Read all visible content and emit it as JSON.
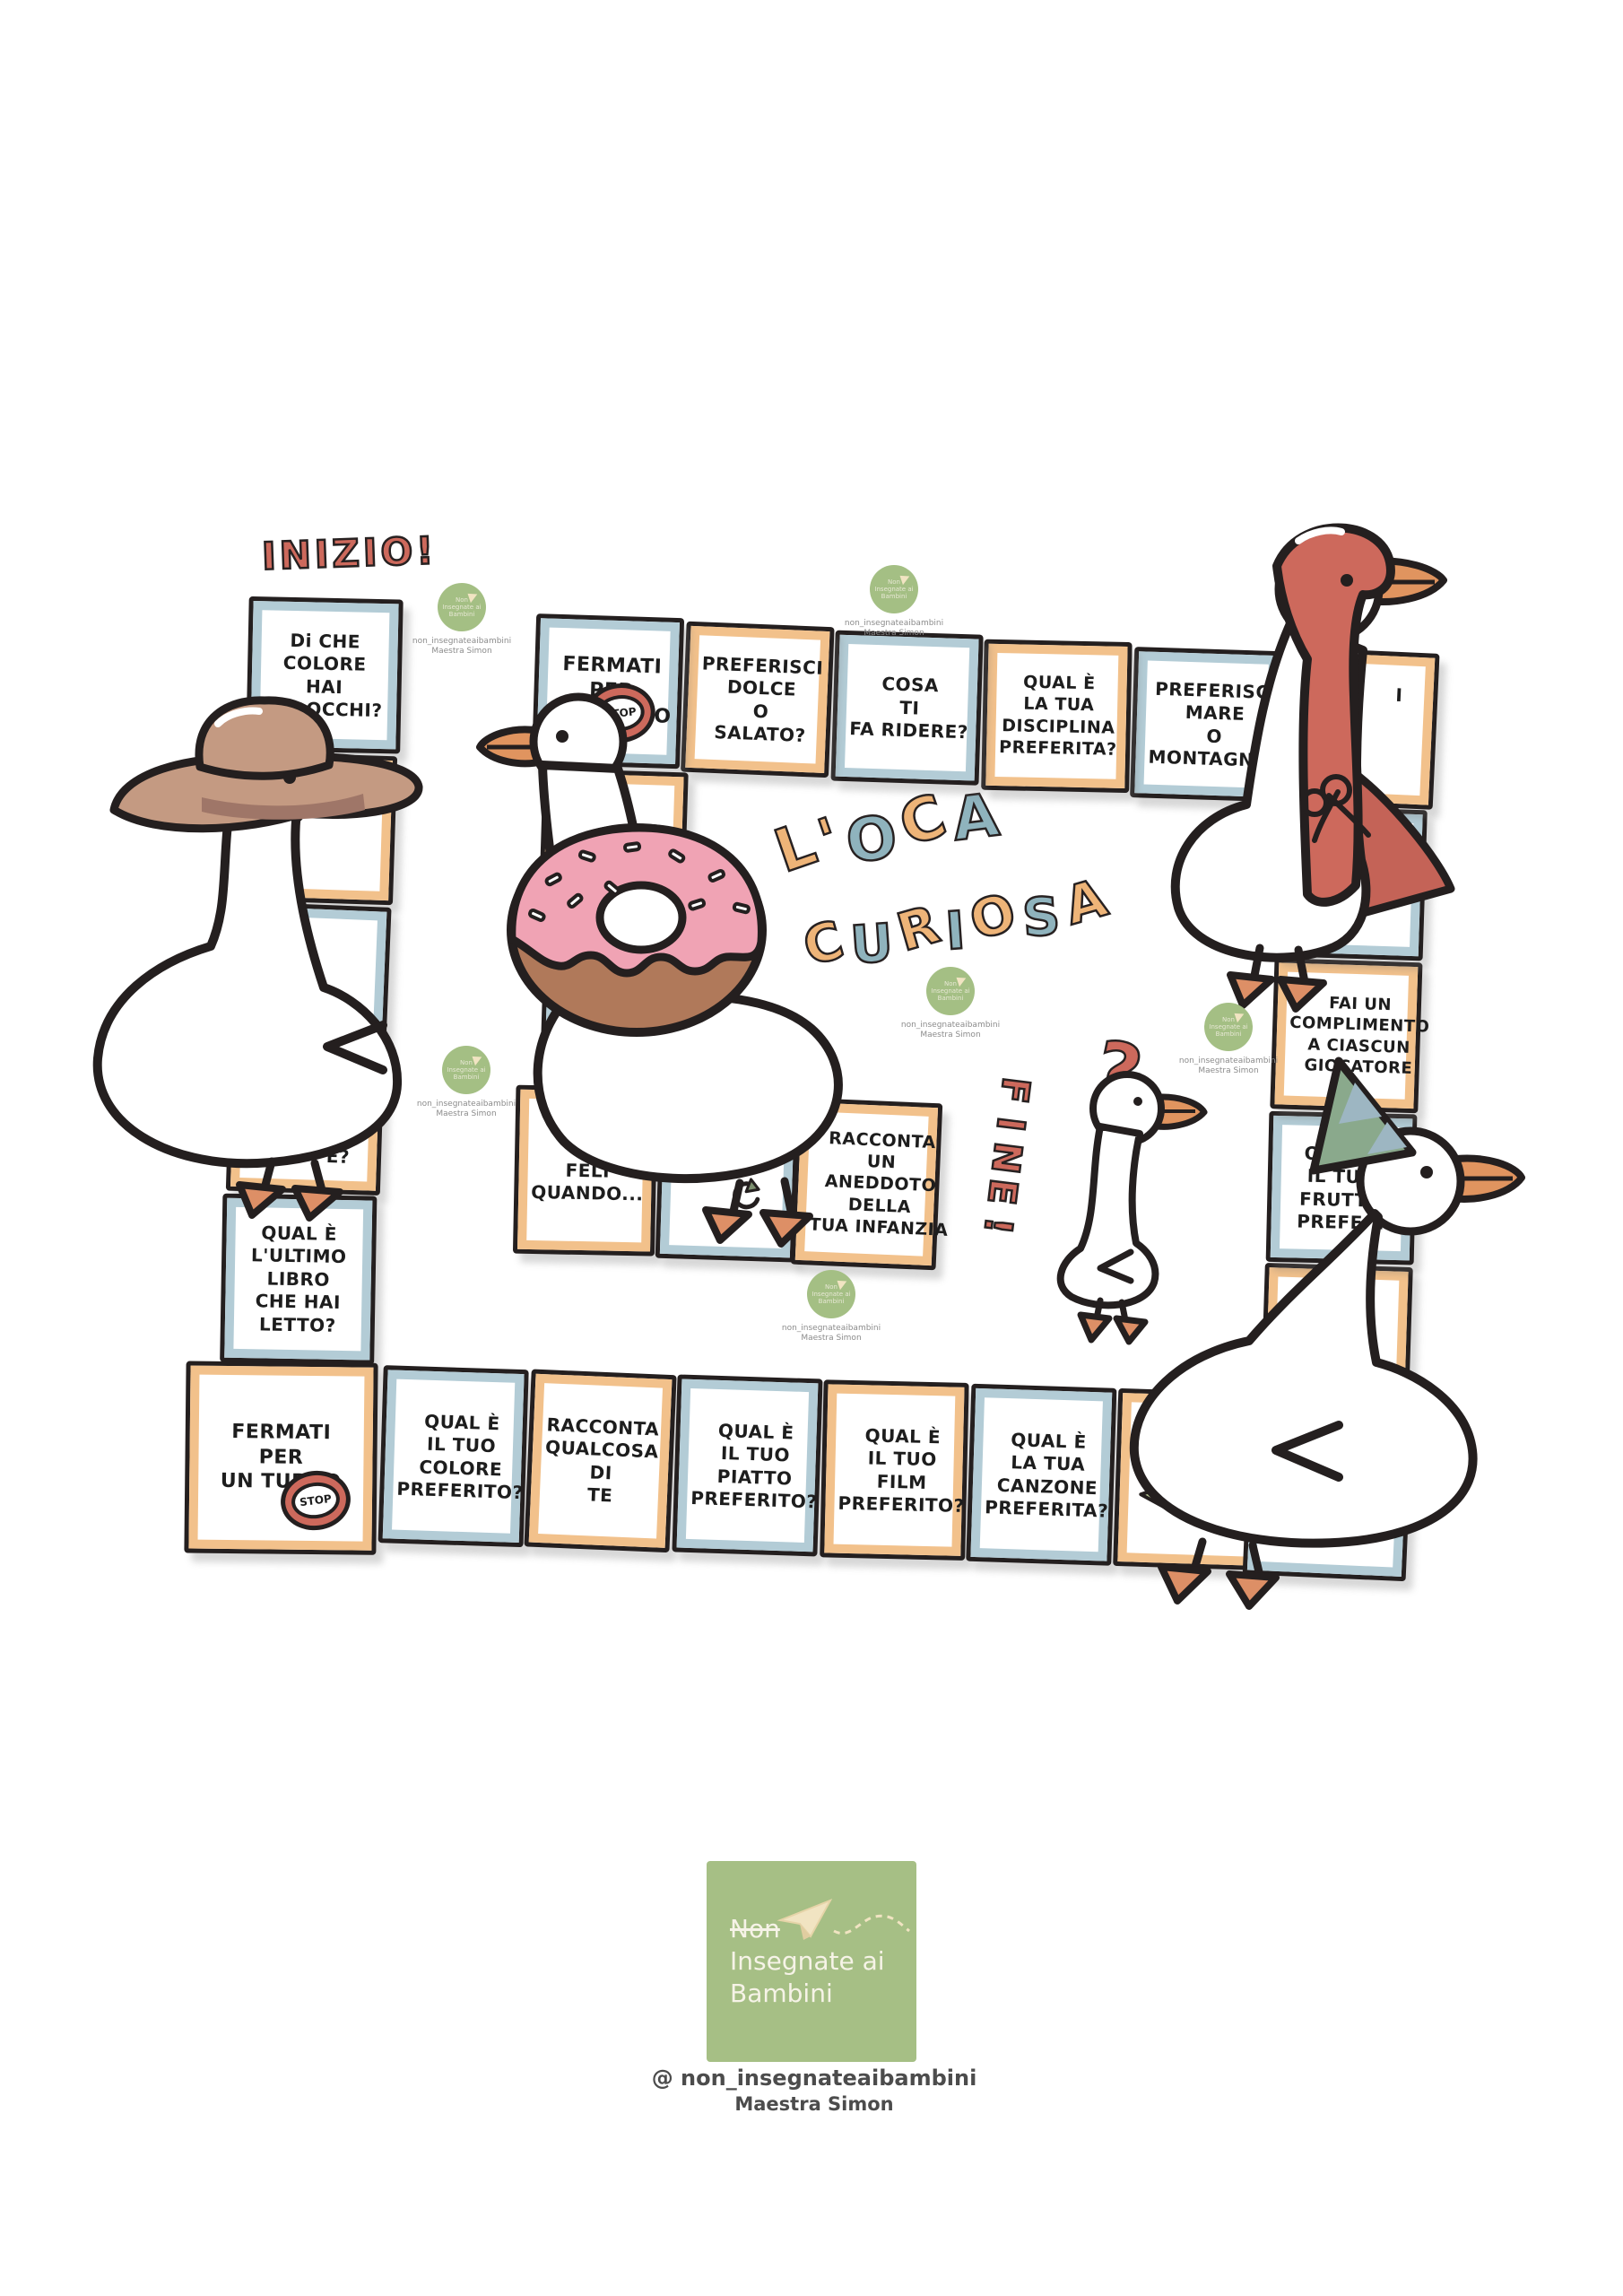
{
  "labels": {
    "start": "INIZIO!",
    "end": "FINE!",
    "stop": "STOP",
    "question_mark": "?"
  },
  "title": {
    "line1": "L'OCA",
    "line2": "CURIOSA"
  },
  "board": {
    "squares": [
      {
        "id": 1,
        "frame": "blue",
        "lines": [
          "Di CHE",
          "COLORE",
          "HAI",
          "GLI OCCHI?"
        ]
      },
      {
        "id": 2,
        "frame": "orange",
        "lines": []
      },
      {
        "id": 3,
        "frame": "blue",
        "lines": []
      },
      {
        "id": 4,
        "frame": "orange",
        "lines": [
          "È?"
        ]
      },
      {
        "id": 5,
        "frame": "blue",
        "lines": [
          "QUAL È",
          "L'ULTIMO",
          "LIBRO",
          "CHE HAI",
          "LETTO?"
        ]
      },
      {
        "id": 6,
        "frame": "orange",
        "lines": [
          "FERMATI",
          "PER",
          "UN TURNO"
        ],
        "icon": "stop"
      },
      {
        "id": 7,
        "frame": "blue",
        "lines": [
          "QUAL È",
          "IL TUO",
          "COLORE",
          "PREFERITO?"
        ]
      },
      {
        "id": 8,
        "frame": "orange",
        "lines": [
          "RACCONTA",
          "QUALCOSA",
          "DI",
          "TE"
        ]
      },
      {
        "id": 9,
        "frame": "blue",
        "lines": [
          "QUAL È",
          "IL TUO",
          "PIATTO",
          "PREFERITO?"
        ]
      },
      {
        "id": 10,
        "frame": "orange",
        "lines": [
          "QUAL È",
          "IL TUO",
          "FILM",
          "PREFERITO?"
        ]
      },
      {
        "id": 11,
        "frame": "blue",
        "lines": [
          "QUAL È",
          "LA TUA",
          "CANZONE",
          "PREFERITA?"
        ]
      },
      {
        "id": 12,
        "frame": "orange",
        "lines": [
          "2 C..."
        ],
        "icon": "arrow-left"
      },
      {
        "id": 13,
        "frame": "blue",
        "lines": [
          "I",
          "...ALE",
          "SARESTI..."
        ]
      },
      {
        "id": 14,
        "frame": "orange",
        "lines": [
          "DE...",
          "...O"
        ]
      },
      {
        "id": 15,
        "frame": "blue",
        "lines": [
          "QUAL È",
          "IL TUO",
          "FRUTTO",
          "PREFE..."
        ]
      },
      {
        "id": 16,
        "frame": "orange",
        "lines": [
          "FAI UN",
          "COMPLIMENTO",
          "A CIASCUN",
          "GIOCATORE"
        ]
      },
      {
        "id": 17,
        "frame": "blue",
        "lines": []
      },
      {
        "id": 18,
        "frame": "orange",
        "lines": [
          "I"
        ]
      },
      {
        "id": 19,
        "frame": "blue",
        "lines": [
          "PREFERISCI",
          "MARE",
          "O",
          "MONTAGNA?"
        ]
      },
      {
        "id": 20,
        "frame": "orange",
        "lines": [
          "QUAL È",
          "LA TUA",
          "DISCIPLINA",
          "PREFERITA?"
        ]
      },
      {
        "id": 21,
        "frame": "blue",
        "lines": [
          "COSA",
          "TI",
          "FA RIDERE?"
        ]
      },
      {
        "id": 22,
        "frame": "orange",
        "lines": [
          "PREFERISCI",
          "DOLCE",
          "O",
          "SALATO?"
        ]
      },
      {
        "id": 23,
        "frame": "blue",
        "lines": [
          "FERMATI",
          "PER",
          "UN TURNO"
        ],
        "icon": "stop"
      },
      {
        "id": 24,
        "frame": "orange",
        "lines": [
          "SU...ERE",
          "VO...?"
        ]
      },
      {
        "id": 25,
        "frame": "blue",
        "lines": []
      },
      {
        "id": 26,
        "frame": "orange",
        "lines": [
          "SE",
          "FELI",
          "QUANDO..."
        ]
      },
      {
        "id": 27,
        "frame": "blue",
        "lines": [],
        "icon": "restart"
      },
      {
        "id": 28,
        "frame": "orange",
        "lines": [
          "RACCONTA",
          "UN",
          "ANEDDOTO",
          "DELLA",
          "TUA INFANZIA"
        ]
      }
    ]
  },
  "watermark": {
    "handle": "non_insegnateaibambini",
    "author": "Maestra Simon"
  },
  "footer": {
    "negation": "Non",
    "brand_line1": "Insegnate ai",
    "brand_line2": "Bambini",
    "handle": "@ non_insegnateaibambini",
    "author": "Maestra Simon"
  },
  "icons": {
    "stop_sign": "stop-sign",
    "restart": "circular-arrow",
    "move_back": "left-arrow"
  },
  "colors": {
    "red": "#cd695c",
    "orange_frame": "#f2c18b",
    "blue_frame": "#b3ccd6",
    "letter_orange": "#eeb478",
    "letter_blue": "#8fb3bd",
    "logo_green": "#a6bf85",
    "arrow_green": "#b3c490",
    "beak_orange": "#e0945f",
    "donut_pink": "#f0a3b4",
    "donut_brown": "#b0795a",
    "hat_tan": "#c49a82",
    "party_hat_green": "#8aa98c",
    "outline": "#241f1f"
  }
}
